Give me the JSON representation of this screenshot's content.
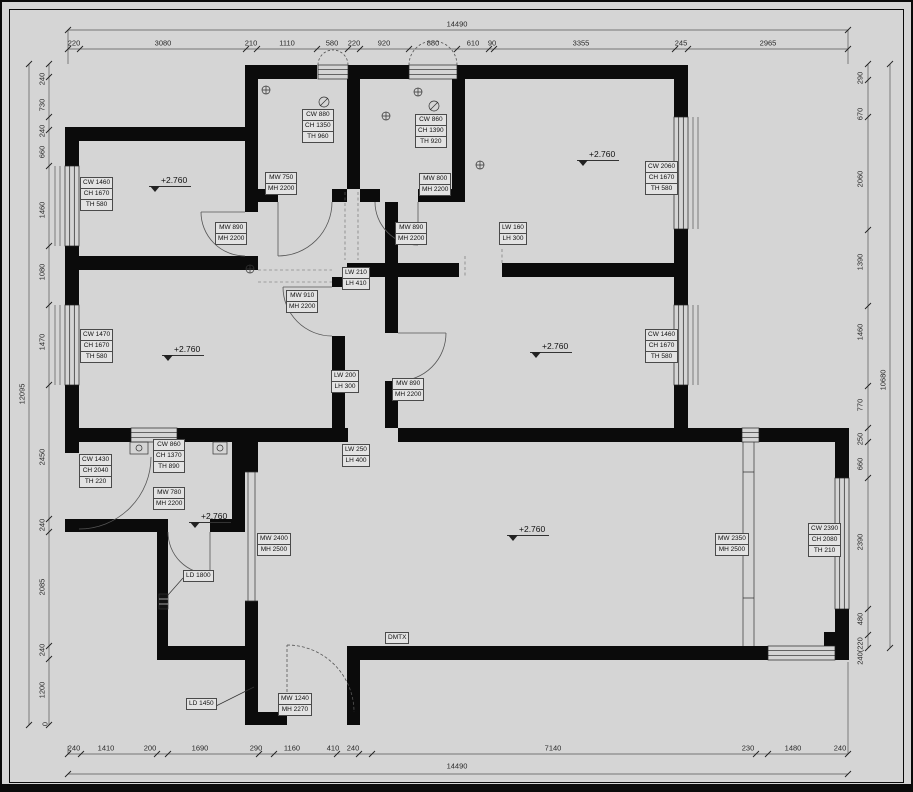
{
  "drawing": {
    "type": "architectural floor plan",
    "level_mark": "+2.760"
  },
  "dims": {
    "top": {
      "overall": "14490",
      "segments": [
        "220",
        "3080",
        "210",
        "1110",
        "580",
        "220",
        "920",
        "880",
        "610",
        "90",
        "3355",
        "245",
        "2965"
      ]
    },
    "bottom": {
      "overall": "14490",
      "segments": [
        "240",
        "1410",
        "200",
        "1690",
        "290",
        "1160",
        "410",
        "240",
        "7140",
        "230",
        "1480",
        "240"
      ]
    },
    "left": {
      "overall": "12095",
      "zero": "0",
      "segments": [
        "240",
        "730",
        "240",
        "660",
        "1460",
        "1080",
        "1470",
        "2450",
        "240",
        "2085",
        "240",
        "1200"
      ]
    },
    "right": {
      "overall": "10680",
      "segments": [
        "290",
        "670",
        "2060",
        "1390",
        "1460",
        "770",
        "250",
        "660",
        "2390",
        "480",
        "240(220"
      ]
    }
  },
  "labels": {
    "cw_closet1": [
      "CW 880",
      "CH 1350",
      "TH 960"
    ],
    "mw_closet1": [
      "MW 750",
      "MH 2200"
    ],
    "cw_closet2": [
      "CW 860",
      "CH 1390",
      "TH 920"
    ],
    "mw_closet2": [
      "MW 800",
      "MH 2200"
    ],
    "cw_bed1": [
      "CW 1460",
      "CH 1670",
      "TH 580"
    ],
    "mw_bed1": [
      "MW 890",
      "MH 2200"
    ],
    "mw_hall_top": [
      "MW 890",
      "MH 2200"
    ],
    "lw_niche1": [
      "LW 160",
      "LH 300"
    ],
    "cw_bed2": [
      "CW 2060",
      "CH 1670",
      "TH 580"
    ],
    "lw_niche2": [
      "LW 210",
      "LH 410"
    ],
    "mw_bed3": [
      "MW 910",
      "MH 2200"
    ],
    "cw_bed3": [
      "CW 1470",
      "CH 1670",
      "TH 580"
    ],
    "lw_niche3": [
      "LW 200",
      "LH 300"
    ],
    "mw_bed4": [
      "MW 890",
      "MH 2200"
    ],
    "cw_bed4": [
      "CW 1460",
      "CH 1670",
      "TH 580"
    ],
    "lw_niche4": [
      "LW 250",
      "LH 400"
    ],
    "cw_balcony_door": [
      "CW 1430",
      "CH 2040",
      "TH 220"
    ],
    "cw_bath": [
      "CW 860",
      "CH 1370",
      "TH 890"
    ],
    "mw_bath": [
      "MW 780",
      "MH 2200"
    ],
    "mw_living_west": [
      "MW 2400",
      "MH 2500"
    ],
    "mw_living_east": [
      "MW 2350",
      "MH 2500"
    ],
    "cw_living": [
      "CW 2390",
      "CH 2080",
      "TH 210"
    ],
    "ld_a": "LD 1800",
    "ld_b": "LD 1450",
    "mw_entry": [
      "MW 1240",
      "MH 2270"
    ],
    "dmtx": "DMTX"
  }
}
